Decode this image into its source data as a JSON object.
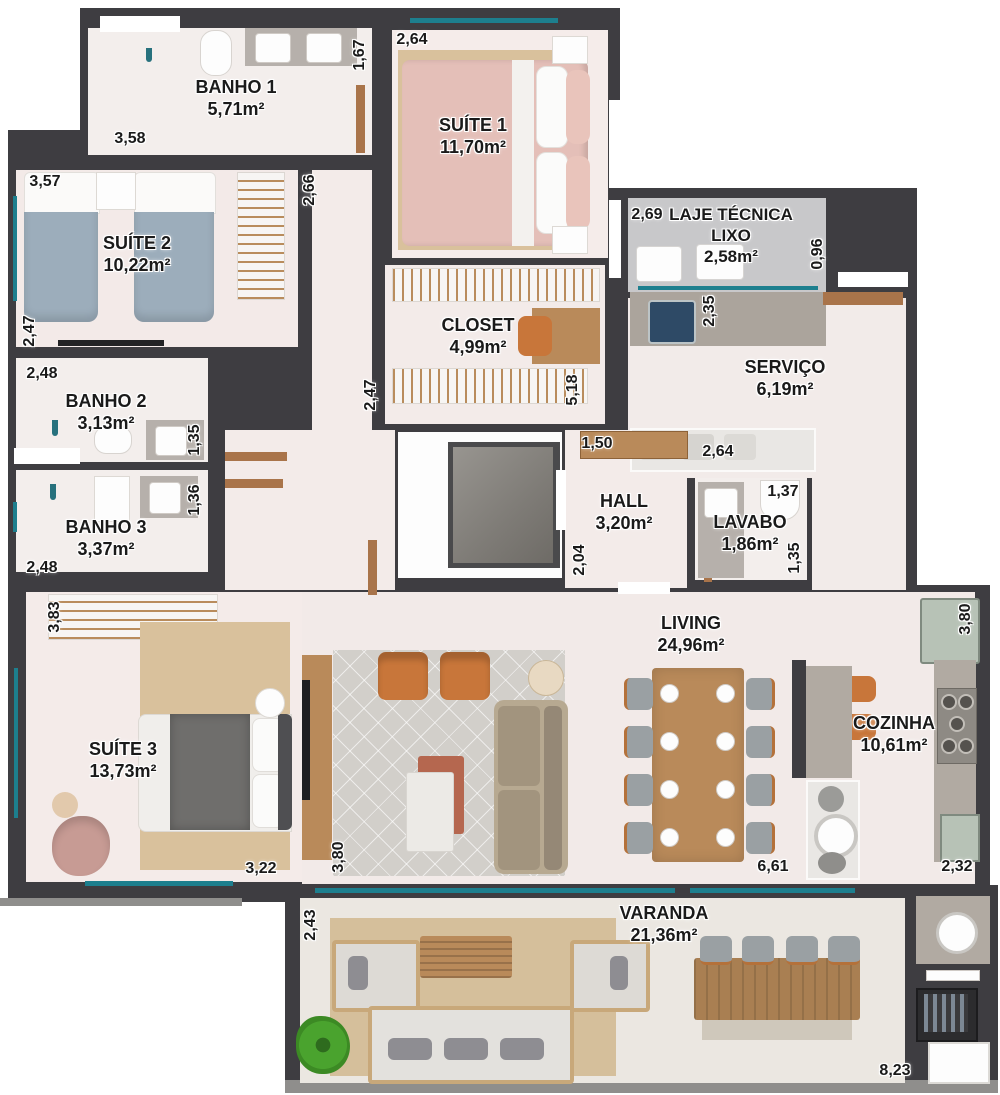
{
  "title": "Apartment floor plan",
  "colors": {
    "wall": "#3e3d41",
    "floor": "#f2eae8",
    "laje_floor": "#c8c8ca",
    "window_glass": "#1d7f8e",
    "wood": "#a9744a",
    "granite": "#b1aaa2",
    "accent_orange": "#c8763a"
  },
  "rooms": {
    "banho1": {
      "name": "BANHO 1",
      "area": "5,71m²"
    },
    "suite1": {
      "name": "SUÍTE 1",
      "area": "11,70m²"
    },
    "suite2": {
      "name": "SUÍTE 2",
      "area": "10,22m²"
    },
    "laje": {
      "name": "LAJE TÉCNICA",
      "subname": "LIXO",
      "area": "2,58m²"
    },
    "closet": {
      "name": "CLOSET",
      "area": "4,99m²"
    },
    "servico": {
      "name": "SERVIÇO",
      "area": "6,19m²"
    },
    "banho2": {
      "name": "BANHO 2",
      "area": "3,13m²"
    },
    "banho3": {
      "name": "BANHO 3",
      "area": "3,37m²"
    },
    "hall": {
      "name": "HALL",
      "area": "3,20m²"
    },
    "lavabo": {
      "name": "LAVABO",
      "area": "1,86m²"
    },
    "suite3": {
      "name": "SUÍTE 3",
      "area": "13,73m²"
    },
    "living": {
      "name": "LIVING",
      "area": "24,96m²"
    },
    "cozinha": {
      "name": "COZINHA",
      "area": "10,61m²"
    },
    "varanda": {
      "name": "VARANDA",
      "area": "21,36m²"
    }
  },
  "dimensions": [
    {
      "label": "1,67",
      "x": 360,
      "y": 55,
      "vertical": true
    },
    {
      "label": "2,64",
      "x": 412,
      "y": 40,
      "vertical": false
    },
    {
      "label": "3,58",
      "x": 130,
      "y": 139,
      "vertical": false
    },
    {
      "label": "3,57",
      "x": 45,
      "y": 182,
      "vertical": false
    },
    {
      "label": "2,66",
      "x": 310,
      "y": 190,
      "vertical": true
    },
    {
      "label": "2,69",
      "x": 647,
      "y": 215,
      "vertical": false
    },
    {
      "label": "0,96",
      "x": 818,
      "y": 254,
      "vertical": true
    },
    {
      "label": "2,47",
      "x": 30,
      "y": 331,
      "vertical": true
    },
    {
      "label": "2,35",
      "x": 710,
      "y": 311,
      "vertical": true
    },
    {
      "label": "2,48",
      "x": 42,
      "y": 374,
      "vertical": false
    },
    {
      "label": "1,35",
      "x": 195,
      "y": 440,
      "vertical": true
    },
    {
      "label": "2,47",
      "x": 371,
      "y": 395,
      "vertical": true
    },
    {
      "label": "5,18",
      "x": 573,
      "y": 390,
      "vertical": true
    },
    {
      "label": "1,50",
      "x": 597,
      "y": 444,
      "vertical": false
    },
    {
      "label": "2,64",
      "x": 718,
      "y": 452,
      "vertical": false
    },
    {
      "label": "1,36",
      "x": 195,
      "y": 500,
      "vertical": true
    },
    {
      "label": "1,37",
      "x": 783,
      "y": 492,
      "vertical": false
    },
    {
      "label": "1,35",
      "x": 795,
      "y": 558,
      "vertical": true
    },
    {
      "label": "2,04",
      "x": 580,
      "y": 560,
      "vertical": true
    },
    {
      "label": "2,48",
      "x": 42,
      "y": 568,
      "vertical": false
    },
    {
      "label": "3,83",
      "x": 55,
      "y": 617,
      "vertical": true
    },
    {
      "label": "3,80",
      "x": 966,
      "y": 619,
      "vertical": true
    },
    {
      "label": "3,22",
      "x": 261,
      "y": 869,
      "vertical": false
    },
    {
      "label": "3,80",
      "x": 339,
      "y": 857,
      "vertical": true
    },
    {
      "label": "6,61",
      "x": 773,
      "y": 867,
      "vertical": false
    },
    {
      "label": "2,32",
      "x": 957,
      "y": 867,
      "vertical": false
    },
    {
      "label": "2,43",
      "x": 311,
      "y": 925,
      "vertical": true
    },
    {
      "label": "8,23",
      "x": 895,
      "y": 1071,
      "vertical": false
    }
  ]
}
